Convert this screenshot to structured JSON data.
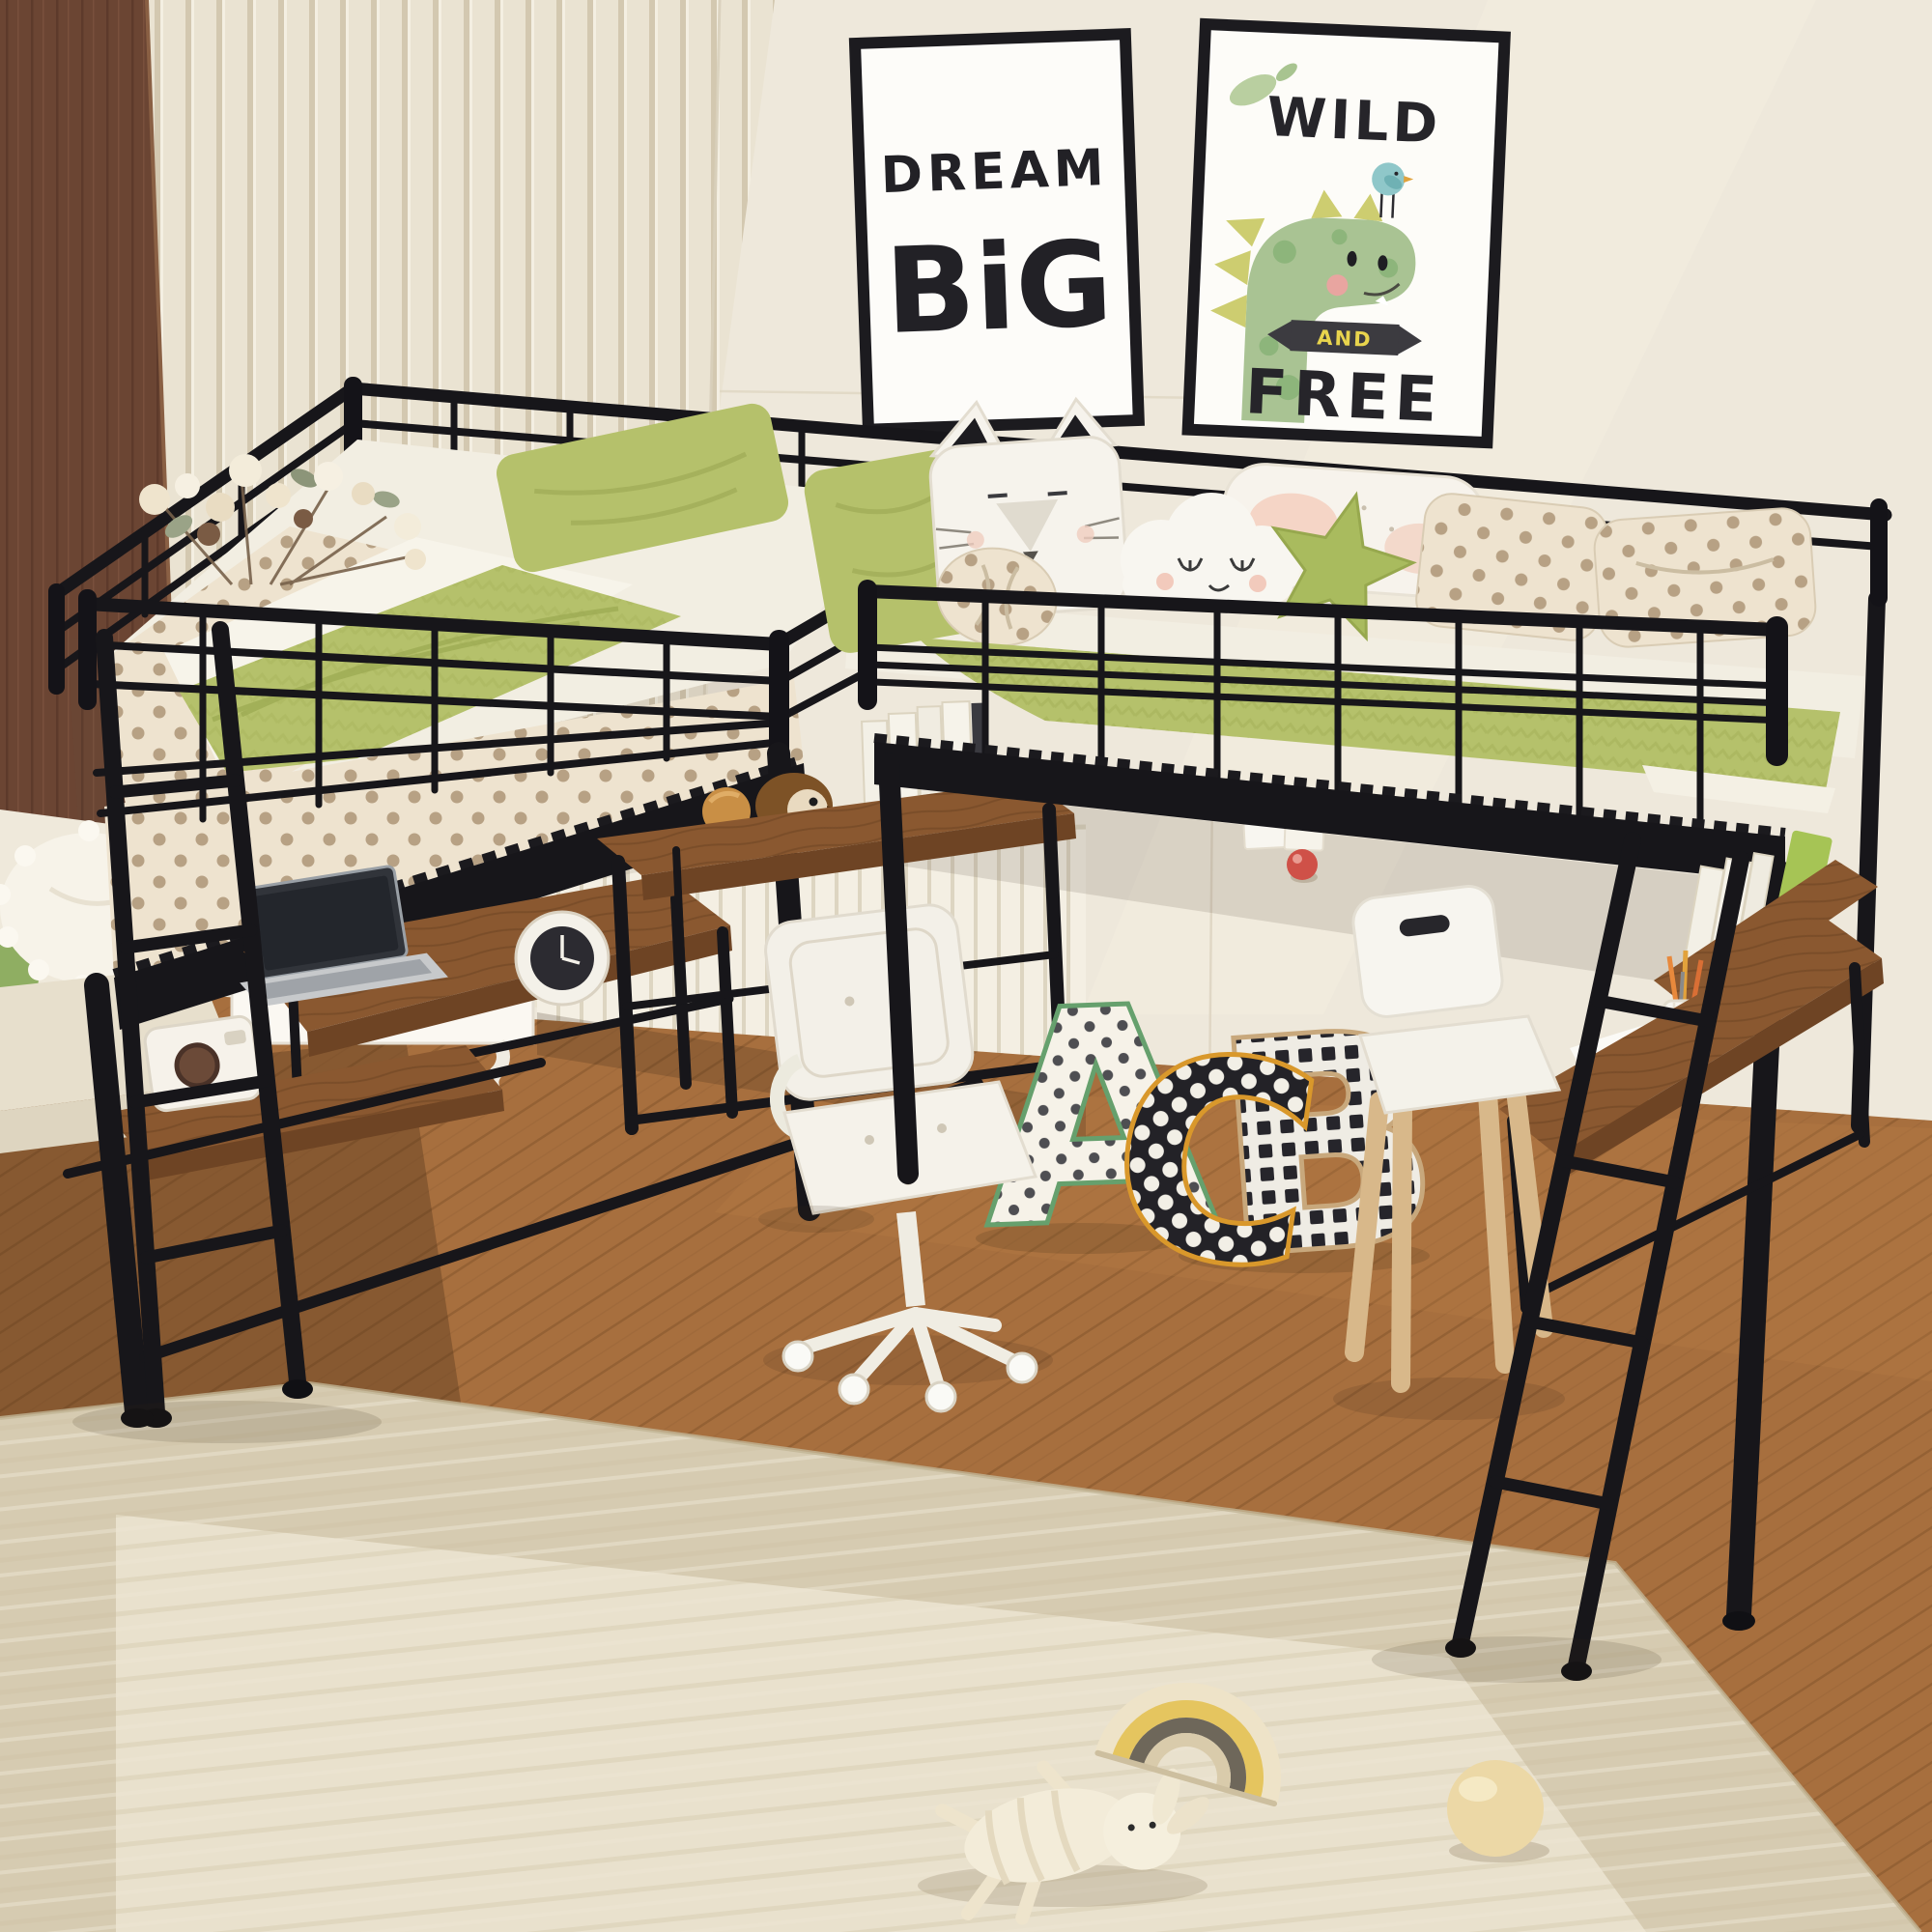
{
  "scene": {
    "title": "Kids bedroom with black metal L-shaped double twin loft bed over desks",
    "style": "product photo, cream wall with slat paneling, wood floor, beige woven rug"
  },
  "posters": {
    "dream_big": {
      "line1": "DREAM",
      "line2": "BiG"
    },
    "wild_free": {
      "word_top": "WILD",
      "banner_word": "AND",
      "word_bottom": "FREE"
    }
  },
  "plush_letters": {
    "first": "A",
    "second": "C",
    "third": "B"
  },
  "colors": {
    "metal_frame": "#17161a",
    "wall_cream": "#eee8db",
    "slat_panel": "#eae3d2",
    "wood_panel_dark": "#6b4533",
    "wainscot_white": "#f4efe3",
    "floor_wood": "#a76f3e",
    "rug_outer": "#d6cbb1",
    "rug_inner": "#e9e1cd",
    "desk_wood": "#8a5830",
    "bedding_green": "#b5c16b",
    "blanket_green_dark": "#a3af57",
    "polka_base": "#eee3cf",
    "polka_dot": "#b7a184",
    "mattress_white": "#f2eee2",
    "chair_white": "#f3f0e8",
    "kids_chair_wood": "#dcbd90",
    "dino_green": "#a9c393",
    "dino_spike_yellow": "#cdcd70",
    "bird_teal": "#8fc7c9",
    "banner_dark": "#3c3b40",
    "banner_text_yellow": "#e8d44d",
    "letter_a_edge": "#66a06d",
    "letter_c_edge": "#d9982b",
    "letter_b_edge": "#c8a87c",
    "knob_red": "#cf5148",
    "rainbow_yellow": "#e5c55f",
    "ball_cream": "#ecd8a6"
  },
  "objects": {
    "left_bed": "twin loft bed with guardrails, green pillow, green blanket, polka-dot sheet, dried flowers on corner",
    "right_bed": "twin loft bed with cat, cloud, star and polka-dot pillows and green chevron blanket",
    "left_desk": "rustic desk under left bed with silver laptop, alarm clock, shelf with camera toy",
    "middle_desk": "rustic desk under right bed with wooden bird toys and white books",
    "right_desk": "rustic desk under right bed right end with pencil cup, paper and book shelf",
    "office_chair": "white tufted swivel chair on casters",
    "kids_chair": "small white chair with wooden legs",
    "ladders": "two black metal ladders, one vertical at left, one slanted at right",
    "toys_on_rug": "striped bunny plush, wooden rainbow stacker, cream ball",
    "sofa_corner": "cream bench with pompom pillow at lower left",
    "drawer_cabinet": "white drawer chest behind left desk"
  }
}
